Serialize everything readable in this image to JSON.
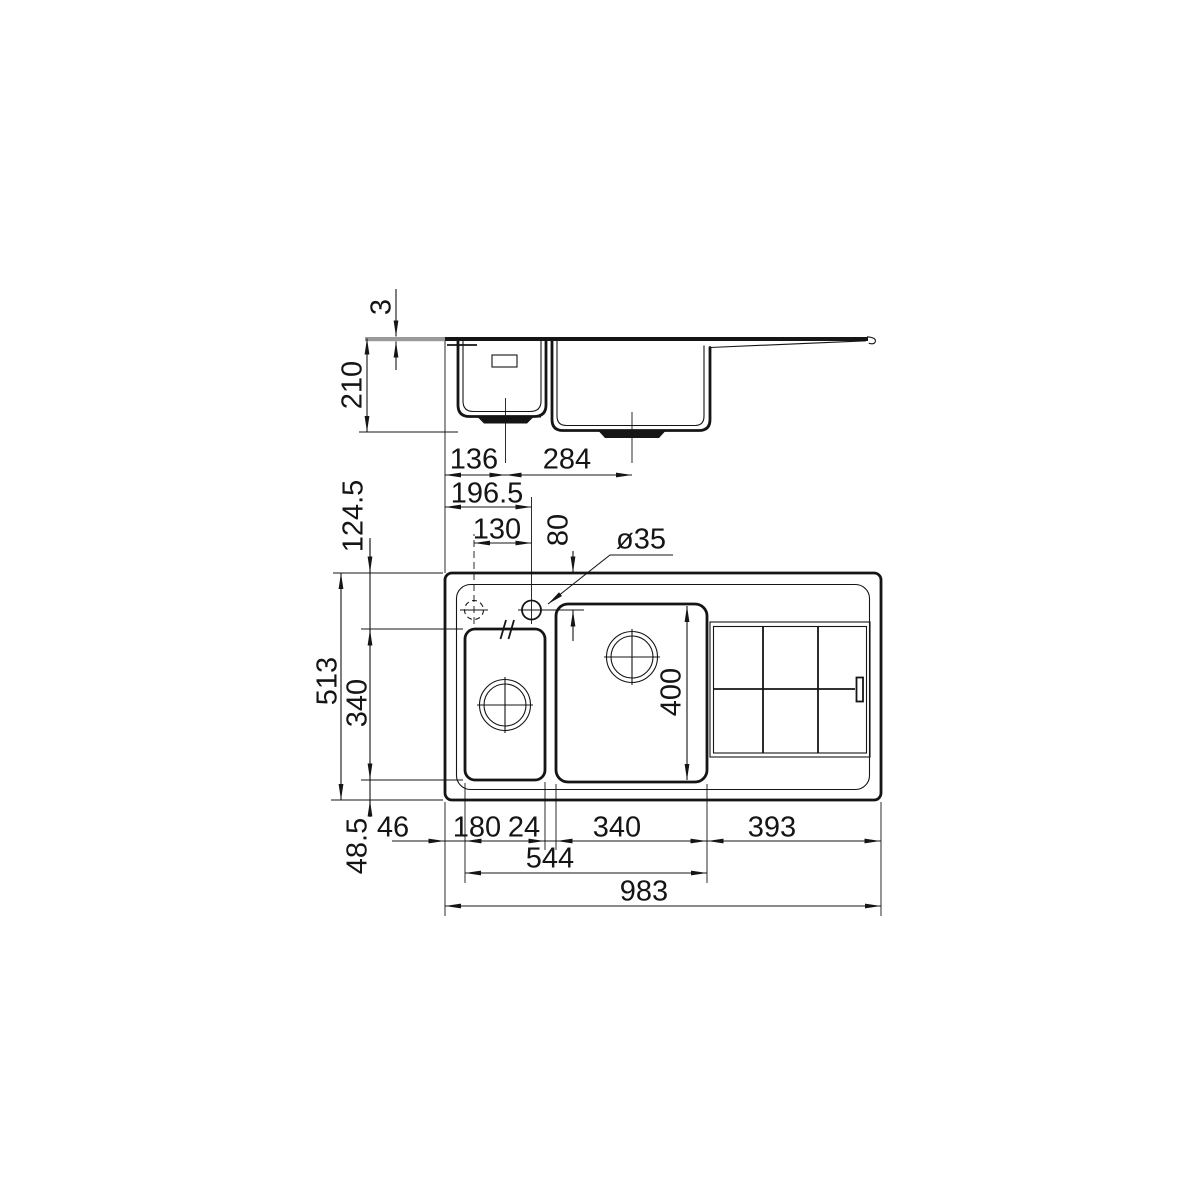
{
  "drawing": {
    "background_color": "#ffffff",
    "line_color": "#151515",
    "views": {
      "side_elevation": {
        "rim_thickness": "3",
        "bowl_depth": "210",
        "left_edge_to_small_drain": "136",
        "small_drain_to_main_drain": "284"
      },
      "plan": {
        "left_edge_to_tap_hole": "196.5",
        "tap_hole_spacing": "130",
        "top_edge_to_tap_hole": "80",
        "tap_hole_diameter": "ø35",
        "top_edge_to_bowls": "124.5",
        "overall_depth": "513",
        "bowl_front_to_back": "340",
        "bowls_to_bottom_edge": "48.5",
        "left_edge_to_small_bowl": "46",
        "small_bowl_width": "180",
        "bowl_gap": "24",
        "main_bowl_width": "340",
        "drainer_width": "393",
        "bowls_total_width": "544",
        "overall_width": "983",
        "main_bowl_length": "400"
      }
    }
  }
}
